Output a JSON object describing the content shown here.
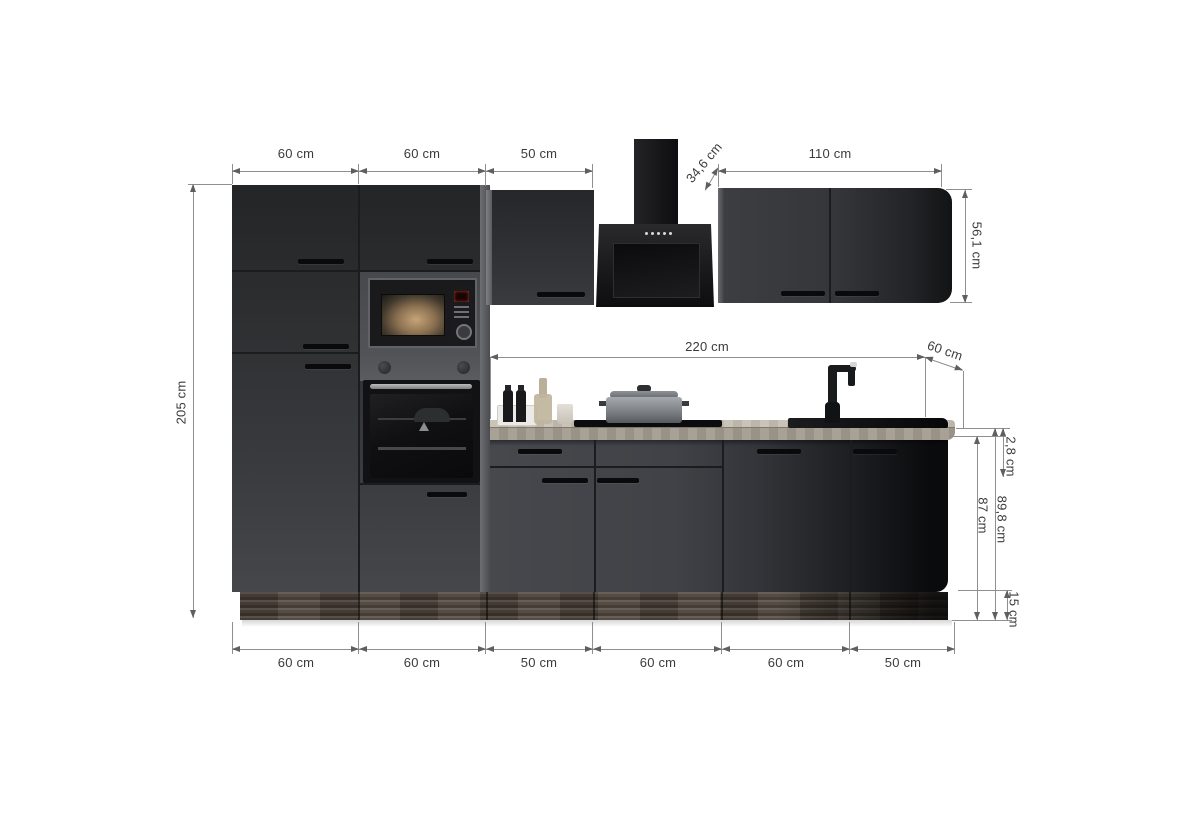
{
  "diagram": {
    "type": "kitchen-unit-dimension-diagram",
    "background": "#ffffff"
  },
  "colors": {
    "cabinet_front_dark": "#303134",
    "cabinet_side_light": "#6a6b70",
    "worktop_wood": "#b7afa3",
    "plinth_wood": "#50473e",
    "appliance_black": "#121214",
    "dimension_line": "#8f8f8f",
    "dimension_text": "#3b3b3b"
  },
  "dimensions": {
    "top_widths": [
      "60 cm",
      "60 cm",
      "50 cm"
    ],
    "hood_wall_cabinet_depth": "34,6 cm",
    "right_wall_cabinet_width": "110 cm",
    "right_wall_cabinet_height": "56,1 cm",
    "worktop_length": "220 cm",
    "worktop_depth": "60 cm",
    "worktop_thickness": "2,8 cm",
    "base_height_with_worktop": "89,8 cm",
    "base_cabinet_height": "87 cm",
    "plinth_height": "15 cm",
    "total_height": "205 cm",
    "bottom_widths": [
      "60 cm",
      "60 cm",
      "50 cm",
      "60 cm",
      "60 cm",
      "50 cm"
    ]
  },
  "scene": {
    "appliances": [
      "microwave",
      "oven",
      "cooker-hood",
      "cooktop",
      "sink",
      "faucet"
    ],
    "props": [
      "cooking-pot",
      "bottle-tray",
      "bottles",
      "carafe",
      "cup"
    ]
  }
}
